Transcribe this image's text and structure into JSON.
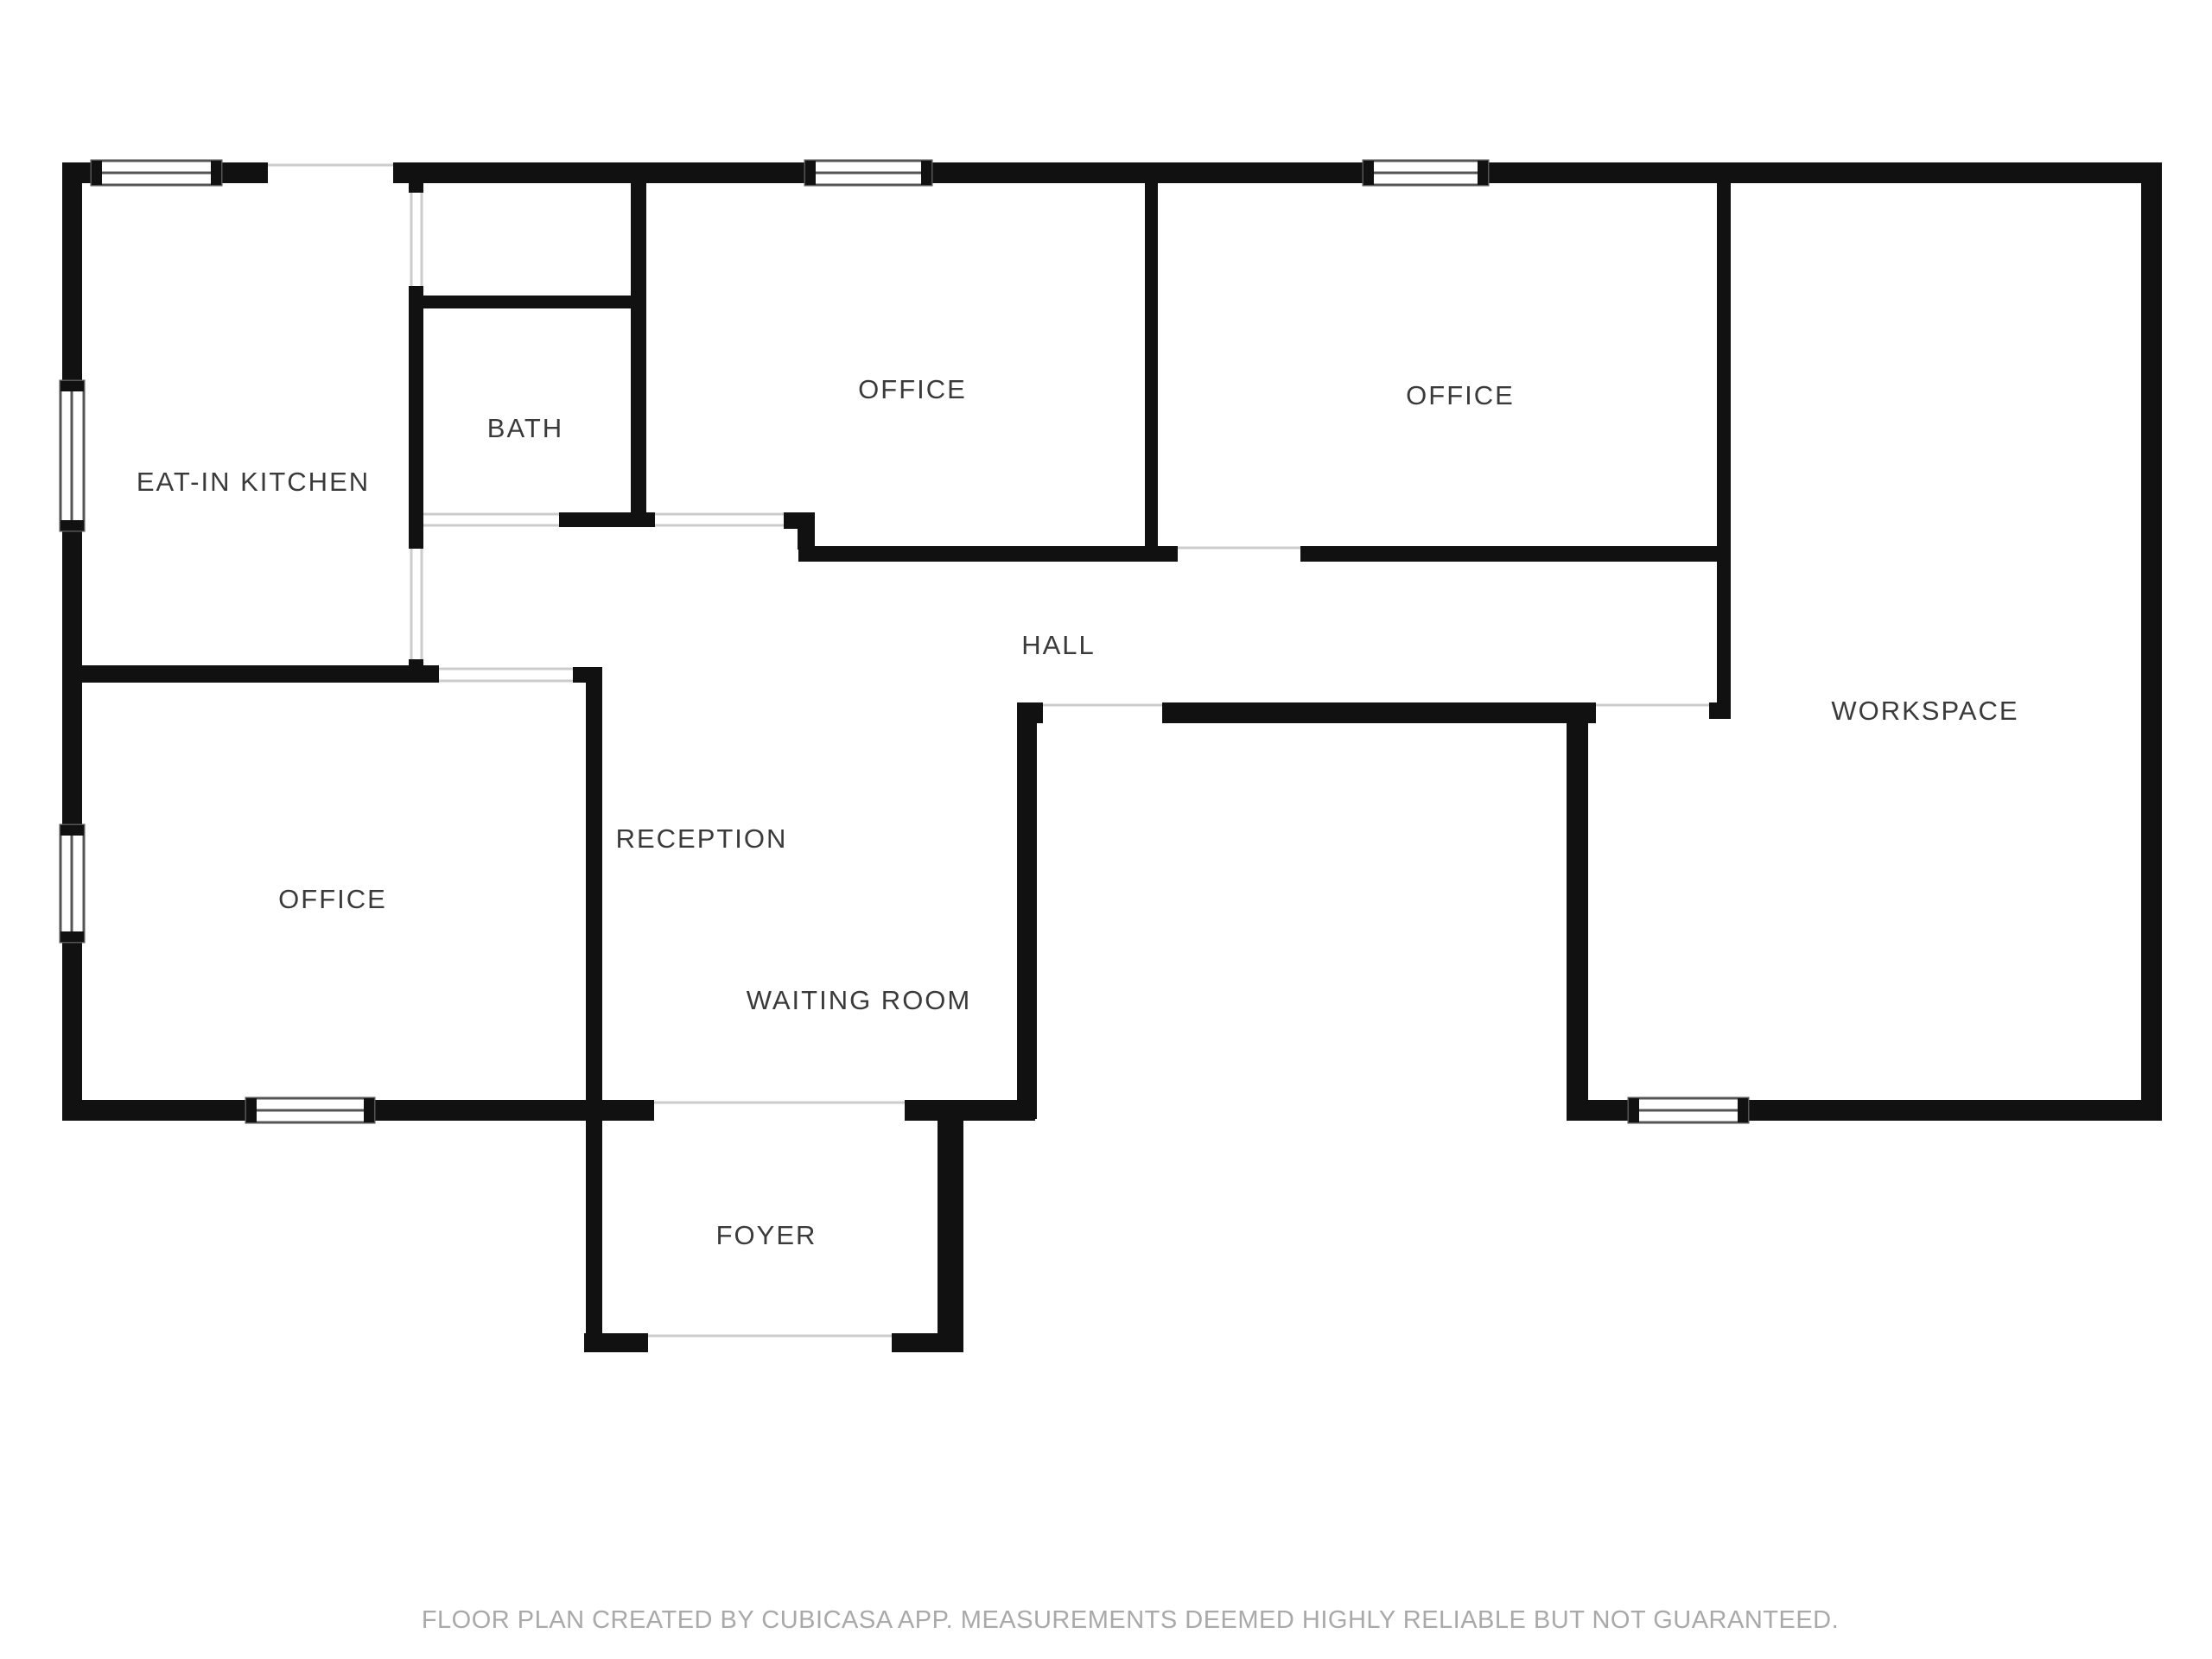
{
  "floorplan": {
    "rooms": [
      {
        "id": "eat-in-kitchen",
        "label": "EAT-IN KITCHEN"
      },
      {
        "id": "bath",
        "label": "BATH"
      },
      {
        "id": "office-top-left",
        "label": "OFFICE"
      },
      {
        "id": "office-top-right",
        "label": "OFFICE"
      },
      {
        "id": "hall",
        "label": "HALL"
      },
      {
        "id": "workspace",
        "label": "WORKSPACE"
      },
      {
        "id": "office-bottom-left",
        "label": "OFFICE"
      },
      {
        "id": "reception",
        "label": "RECEPTION"
      },
      {
        "id": "waiting-room",
        "label": "WAITING ROOM"
      },
      {
        "id": "foyer",
        "label": "FOYER"
      }
    ],
    "footer": "FLOOR PLAN CREATED BY CUBICASA APP. MEASUREMENTS DEEMED HIGHLY RELIABLE BUT NOT GUARANTEED.",
    "colors": {
      "wall": "#111111",
      "background": "#ffffff",
      "label": "#3a3a3a",
      "footer": "#a9a9a9",
      "window_line": "#555555",
      "threshold": "#cccccc"
    }
  }
}
